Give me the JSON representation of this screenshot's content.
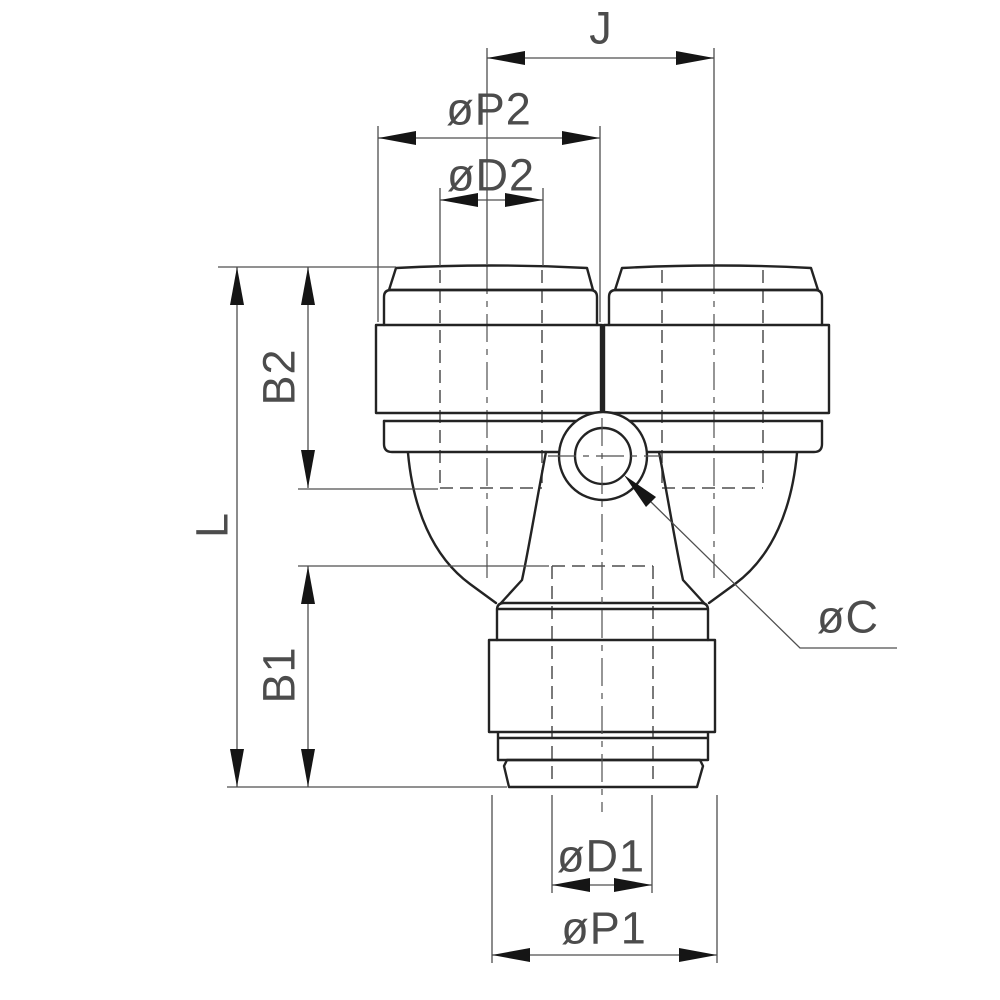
{
  "drawing": {
    "colors": {
      "outline": "#232323",
      "thin": "#4f4f4f",
      "arrow": "#151515",
      "text": "#4c4c4c",
      "bg": "#ffffff"
    },
    "labels": {
      "j": "J",
      "p2": "øP2",
      "d2": "øD2",
      "b2": "B2",
      "l": "L",
      "b1": "B1",
      "c": "øC",
      "d1": "øD1",
      "p1": "øP1"
    }
  }
}
